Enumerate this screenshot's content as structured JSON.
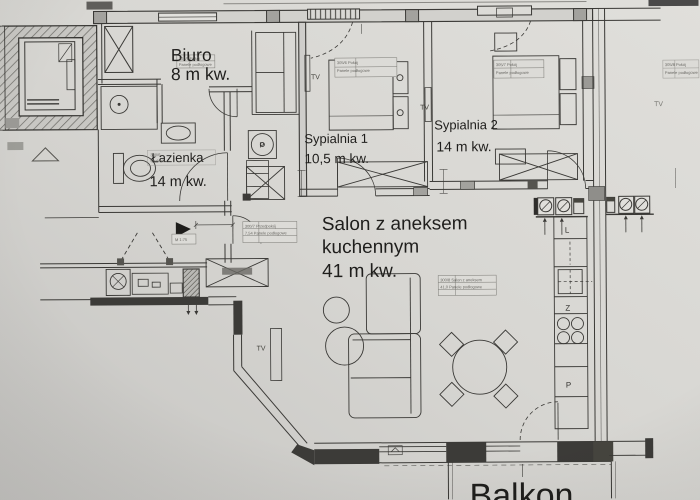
{
  "photo": {
    "paper_light": "#e0dfdb",
    "paper_mid": "#d7d6d2",
    "paper_dark": "#c6c5c2",
    "ink": "#3a3936",
    "wall_dark": "#3c3b38",
    "wall_gray": "#a3a29e",
    "label_color": "#1f1e1c"
  },
  "rooms": {
    "biuro": {
      "name": "Biuro",
      "area": "8 m kw."
    },
    "lazienka": {
      "name": "Łazienka",
      "area": "14 m kw."
    },
    "sypialnia1": {
      "name": "Sypialnia 1",
      "area": "10,5 m kw."
    },
    "sypialnia2": {
      "name": "Sypialnia 2",
      "area": "14 m kw."
    },
    "salon": {
      "name1": "Salon z aneksem",
      "name2": "kuchennym",
      "area": "41 m kw."
    },
    "balkon": {
      "name": "Balkon"
    }
  },
  "symbols": {
    "tv_sypialnia1": "TV",
    "tv_sypialnia2": "TV",
    "tv_salon": "TV",
    "tv_neighbor": "TV",
    "washer": "P",
    "fridge": "L",
    "dishwasher": "Z",
    "appliance_p": "P"
  },
  "micro_annotations": {
    "biuro": {
      "l1": "305/5  Pokój",
      "l2": "Panele podłogowe"
    },
    "sypialnia1": {
      "l1": "305/6  Pokój",
      "l2": "Panele podłogowe"
    },
    "sypialnia2": {
      "l1": "305/7  Pokój",
      "l2": "Panele podłogowe"
    },
    "przedpokoj": {
      "l1": "300/7  Przedpokój",
      "l2": "7,54  Panele podłogowe"
    },
    "salon": {
      "l1": "300/8  Salon z aneksem",
      "l2": "41,0  Panele podłogowe"
    },
    "lazienka": {
      "l1": "300/6",
      "l2": "terakota"
    },
    "entrance": {
      "l1": "M 1:75"
    },
    "neighbor": {
      "l1": "305/8  Pokój",
      "l2": "Panele podłogowe"
    }
  }
}
